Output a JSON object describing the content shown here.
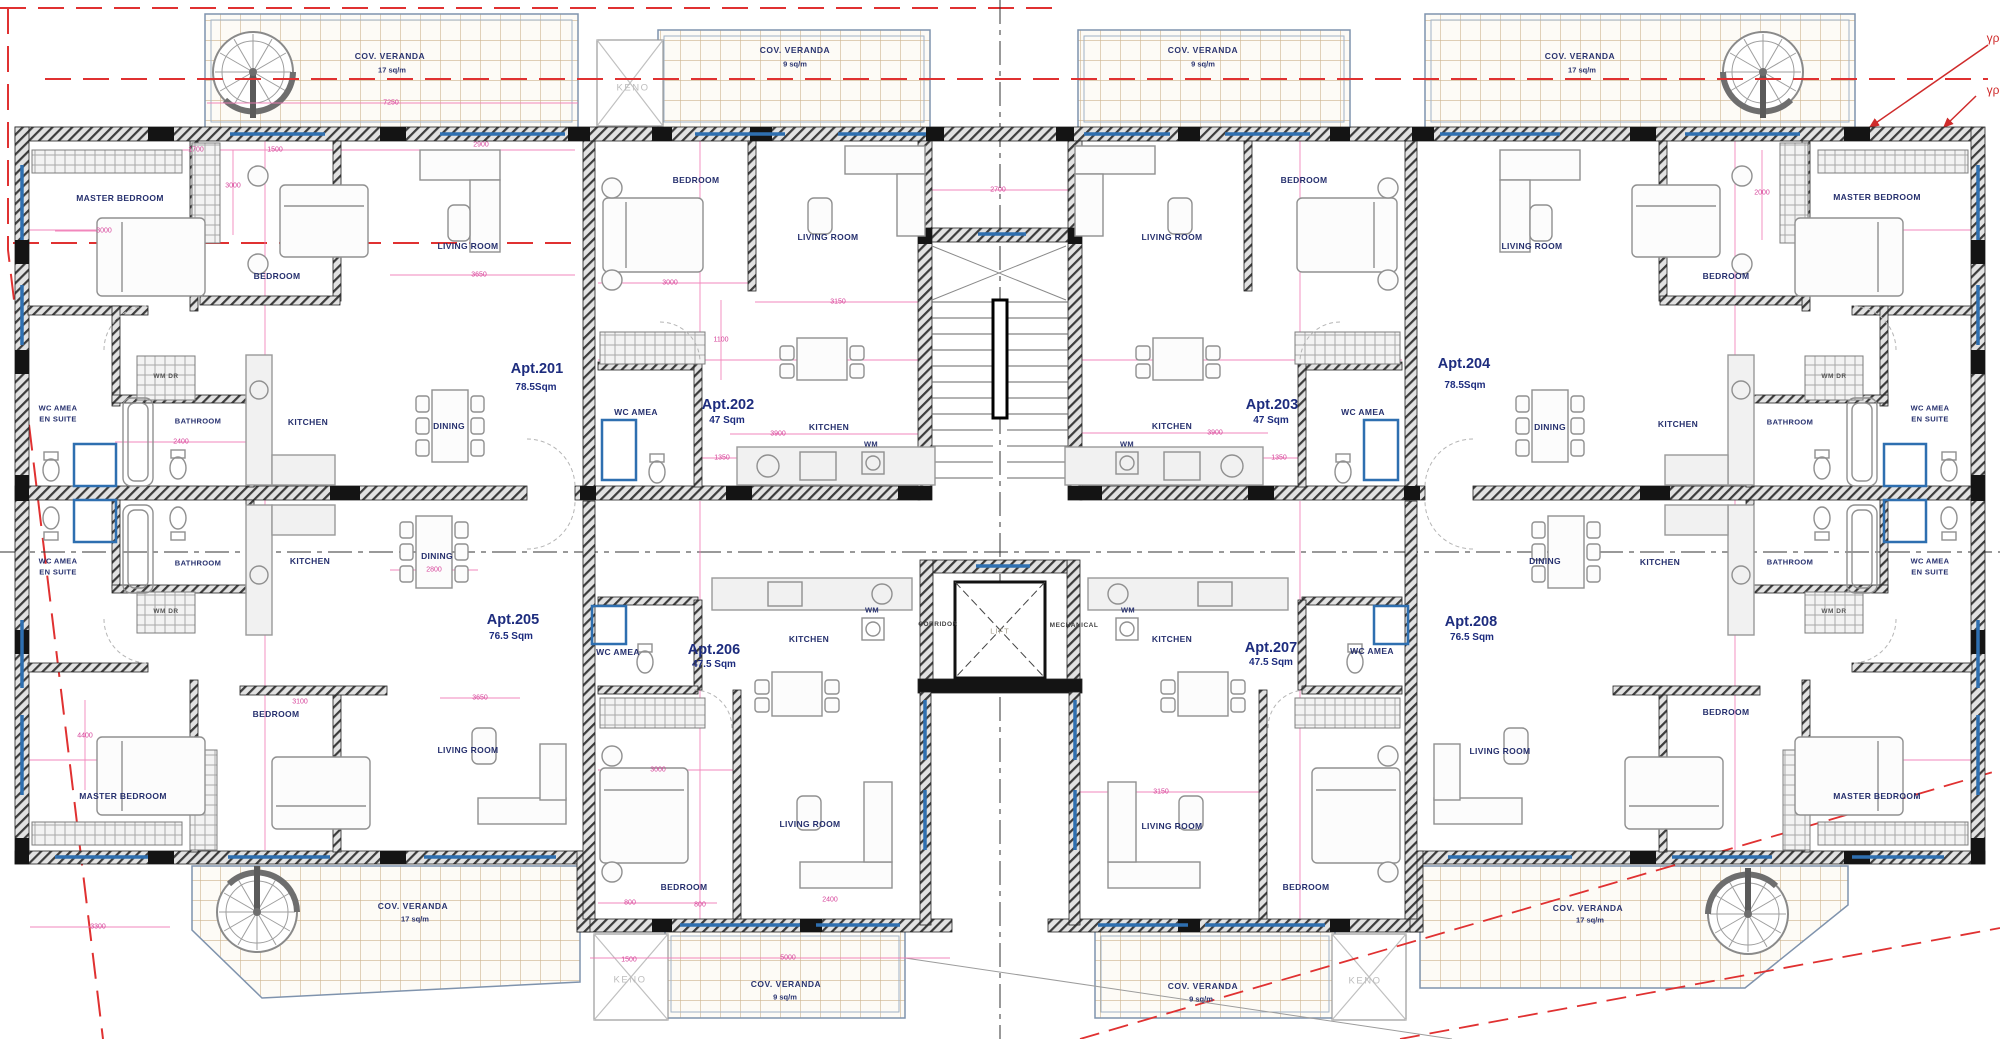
{
  "apartments": [
    {
      "name": "Apt.201",
      "area": "78.5Sqm"
    },
    {
      "name": "Apt.202",
      "area": "47 Sqm"
    },
    {
      "name": "Apt.203",
      "area": "47 Sqm"
    },
    {
      "name": "Apt.204",
      "area": "78.5Sqm"
    },
    {
      "name": "Apt.205",
      "area": "76.5 Sqm"
    },
    {
      "name": "Apt.206",
      "area": "47.5 Sqm"
    },
    {
      "name": "Apt.207",
      "area": "47.5 Sqm"
    },
    {
      "name": "Apt.208",
      "area": "76.5 Sqm"
    }
  ],
  "rooms": {
    "master_bedroom": "MASTER BEDROOM",
    "bedroom": "BEDROOM",
    "living_room": "LIVING ROOM",
    "dining": "DINING",
    "kitchen": "KITCHEN",
    "bathroom": "BATHROOM",
    "wc_amea": "WC AMEA",
    "en_suite": "EN SUITE",
    "wm": "WM",
    "wm_dr": "WM DR",
    "keno": "KENO"
  },
  "core": {
    "lift": "LIFT",
    "corridor": "CORRIDOR",
    "mechanical": "MECHANICAL"
  },
  "veranda": {
    "label": "COV. VERANDA",
    "area_17": "17 sq/m",
    "area_9": "9 sq/m"
  },
  "annotations": {
    "greek_note_1": "γραμ",
    "greek_note_2": "γραμ"
  },
  "dimensions": [
    "1700",
    "1500",
    "2900",
    "7250",
    "3000",
    "3000",
    "3650",
    "3150",
    "2700",
    "3000",
    "2400",
    "3900",
    "3900",
    "1350",
    "1350",
    "2800",
    "3650",
    "3000",
    "3150",
    "1500",
    "5000",
    "800",
    "800",
    "2400",
    "3300",
    "4400",
    "3100",
    "2000",
    "1100"
  ]
}
